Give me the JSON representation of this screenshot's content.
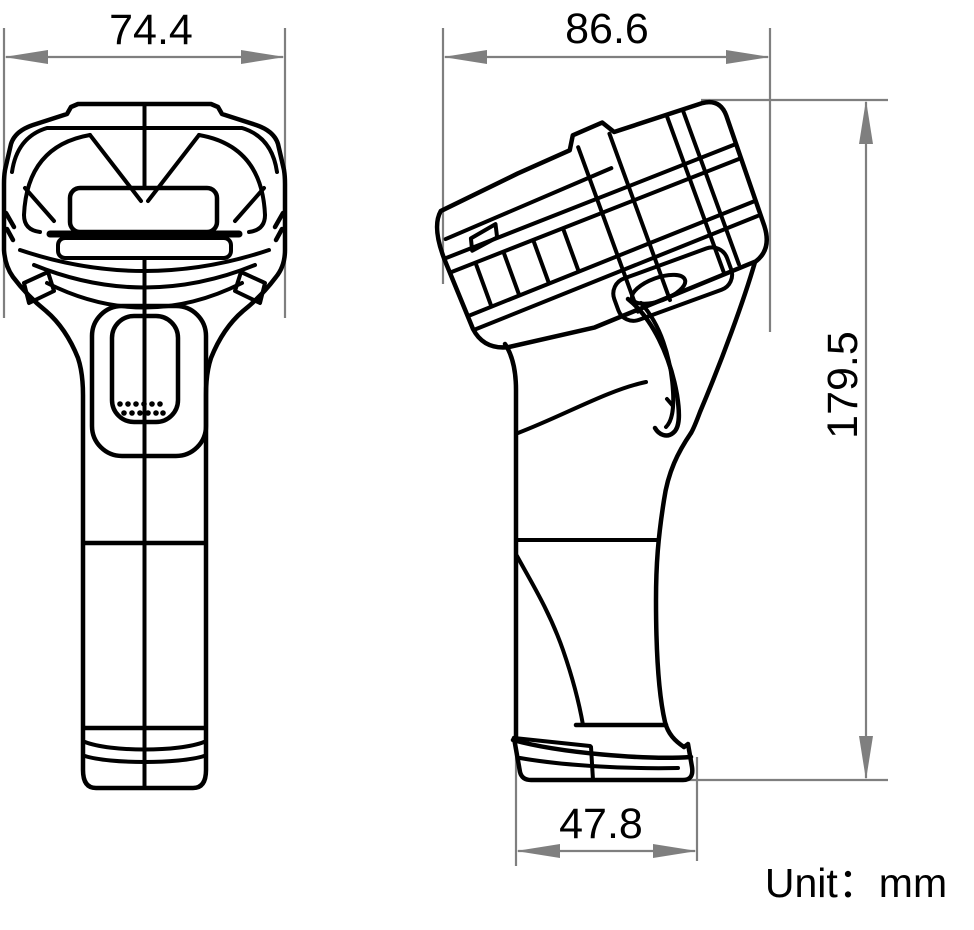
{
  "diagram": {
    "type": "technical-dimension-drawing",
    "subject": "handheld-barcode-scanner",
    "unit_label": "Unit：mm",
    "views": {
      "front": {
        "name": "front-view",
        "width_label": "74.4"
      },
      "side": {
        "name": "side-view",
        "depth_label": "86.6",
        "height_label": "179.5",
        "base_label": "47.8"
      }
    },
    "dimensions": {
      "front_width": "74.4",
      "head_depth": "86.6",
      "overall_height": "179.5",
      "base_depth": "47.8"
    },
    "colors": {
      "outline": "#000000",
      "dimension_lines": "#7f7f7f",
      "background": "#ffffff",
      "text": "#000000"
    }
  }
}
